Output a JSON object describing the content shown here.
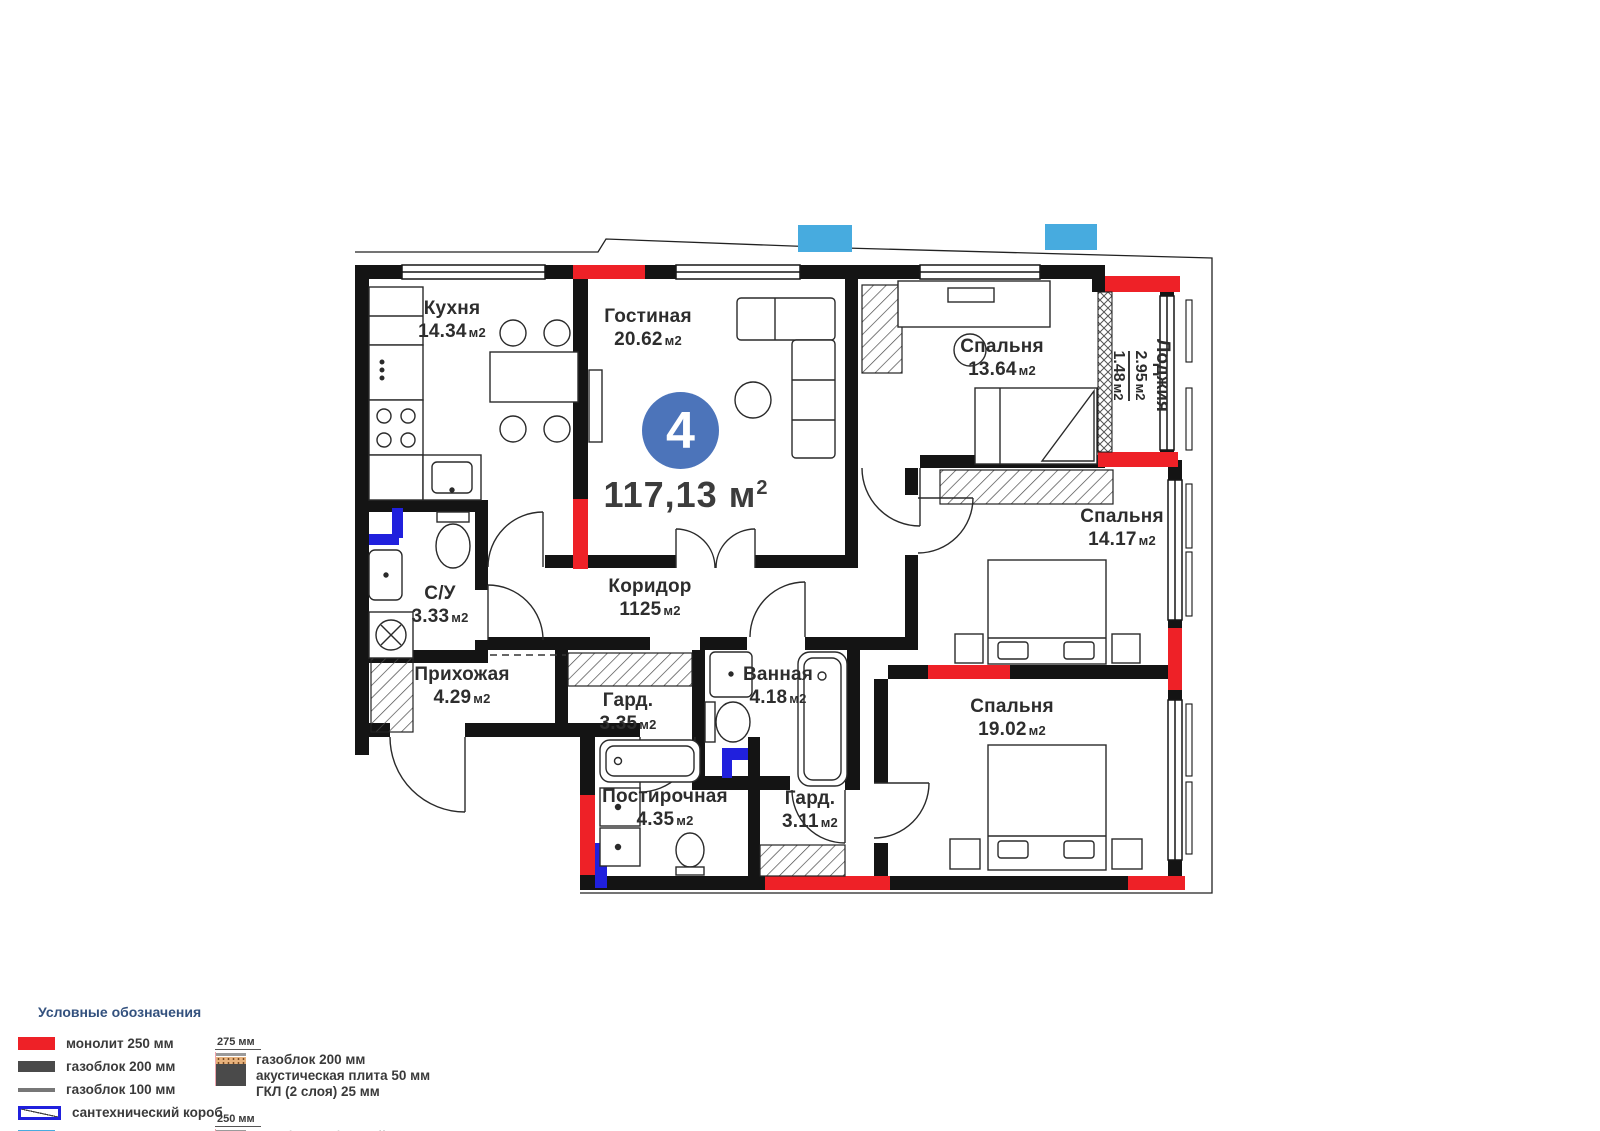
{
  "unit": {
    "number": "4",
    "total_area": "117,13",
    "area_unit": "м",
    "area_exp": "2"
  },
  "rooms": [
    {
      "name": "Кухня",
      "area": "14.34",
      "unit": "м2"
    },
    {
      "name": "Гостиная",
      "area": "20.62",
      "unit": "м2"
    },
    {
      "name": "Спальня",
      "area": "13.64",
      "unit": "м2"
    },
    {
      "name": "Лоджия",
      "area_total": "2.95",
      "area_reduced": "1.48",
      "unit": "м2"
    },
    {
      "name": "Коридор",
      "area": "1125",
      "unit": "м2"
    },
    {
      "name": "С/У",
      "area": "3.33",
      "unit": "м2"
    },
    {
      "name": "Прихожая",
      "area": "4.29",
      "unit": "м2"
    },
    {
      "name": "Гард.",
      "area": "3.35",
      "unit": "м2"
    },
    {
      "name": "Ванная",
      "area": "4.18",
      "unit": "м2"
    },
    {
      "name": "Спальня",
      "area": "14.17",
      "unit": "м2"
    },
    {
      "name": "Постирочная",
      "area": "4.35",
      "unit": "м2"
    },
    {
      "name": "Гард.",
      "area": "3.11",
      "unit": "м2"
    },
    {
      "name": "Спальня",
      "area": "19.02",
      "unit": "м2"
    }
  ],
  "legend": {
    "title": "Условные обозначения",
    "items": [
      {
        "label": "монолит 250 мм",
        "swatch": "monolith-wall",
        "color": "#ee2127"
      },
      {
        "label": "газоблок 200 мм",
        "swatch": "gasblock-200",
        "color": "#4a4a4a"
      },
      {
        "label": "газоблок 100 мм",
        "swatch": "gasblock-100",
        "color": "#777777"
      },
      {
        "label": "сантехнический короб",
        "swatch": "plumbing-box",
        "color": "#2020dd"
      },
      {
        "label": "место для кондиционера",
        "swatch": "ac-spot",
        "color": "#47abdf"
      }
    ],
    "wall_types": [
      {
        "dimension": "275 мм",
        "lines": [
          "газоблок 200 мм",
          "акустическая плита 50 мм",
          "ГКЛ (2 слоя) 25 мм"
        ]
      },
      {
        "dimension": "250 мм",
        "lines": [
          "газоблок (обшитый с 2 сторон",
          "акустической плитой)",
          "ГКЛ ( 2 слоя)"
        ]
      }
    ]
  },
  "colors": {
    "monolith_red": "#ee2127",
    "plumbing_blue": "#2020dd",
    "ac_blue": "#47abdf",
    "badge_blue": "#4c74ba",
    "legend_title_blue": "#33517e",
    "wall_black": "#141414"
  }
}
